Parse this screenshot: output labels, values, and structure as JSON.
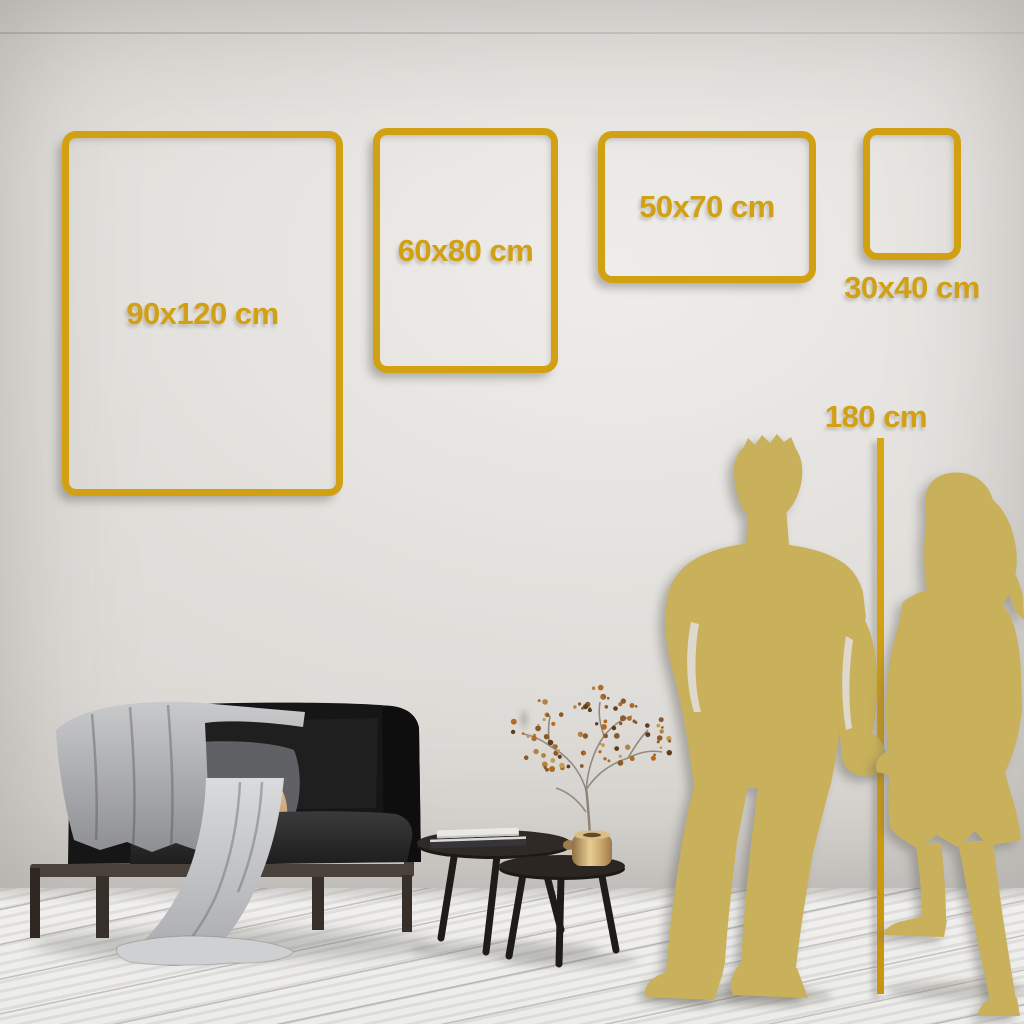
{
  "scene": {
    "description": "room-wall mockup used as a poster / wall-art size guide",
    "elements": [
      "sofa with throw blanket and pillows",
      "nesting coffee tables with books",
      "brass vase with dried branch",
      "couple silhouettes holding hands",
      "whitewashed wood floor"
    ]
  },
  "frames": [
    {
      "label": "90x120 cm",
      "width_cm": 90,
      "height_cm": 120,
      "orientation": "portrait",
      "label_position": "inside"
    },
    {
      "label": "60x80 cm",
      "width_cm": 60,
      "height_cm": 80,
      "orientation": "portrait",
      "label_position": "inside"
    },
    {
      "label": "50x70 cm",
      "width_cm": 50,
      "height_cm": 70,
      "orientation": "landscape",
      "label_position": "inside"
    },
    {
      "label": "30x40 cm",
      "width_cm": 30,
      "height_cm": 40,
      "orientation": "portrait",
      "label_position": "below"
    }
  ],
  "height_reference": {
    "label": "180 cm",
    "value_cm": 180
  },
  "colors": {
    "accent_gold": "#d2a013",
    "silhouette_gold": "#c8b15a",
    "wall": "#dedbd7",
    "floor": "#f1f0ee"
  }
}
